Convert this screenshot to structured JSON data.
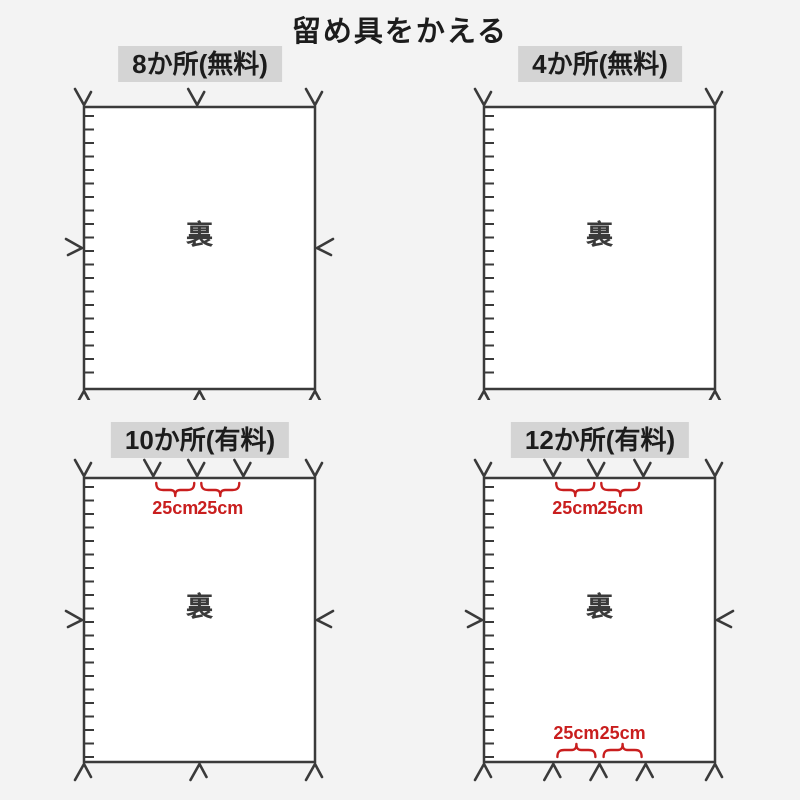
{
  "title": "留め具をかえる",
  "colors": {
    "background": "#f3f3f3",
    "panel_fill": "#ffffff",
    "line": "#3a3a3a",
    "header_bg": "#d4d4d4",
    "accent_red": "#c91e1e"
  },
  "panels": [
    {
      "id": "8-places-free",
      "label": "8か所(無料)",
      "center_label": "裏",
      "top_marks": [
        0,
        0.49,
        1
      ],
      "bottom_marks": [
        0,
        0.5,
        1
      ],
      "side_marks": true,
      "top_braces": [],
      "bottom_braces": []
    },
    {
      "id": "4-places-free",
      "label": "4か所(無料)",
      "center_label": "裏",
      "top_marks": [
        0,
        1
      ],
      "bottom_marks": [
        0,
        1
      ],
      "side_marks": false,
      "top_braces": [],
      "bottom_braces": []
    },
    {
      "id": "10-places-paid",
      "label": "10か所(有料)",
      "center_label": "裏",
      "top_marks": [
        0,
        0.3,
        0.49,
        0.69,
        1
      ],
      "bottom_marks": [
        0,
        0.5,
        1
      ],
      "side_marks": true,
      "top_braces": [
        {
          "between": [
            1,
            2
          ],
          "label": "25cm"
        },
        {
          "between": [
            2,
            3
          ],
          "label": "25cm"
        }
      ],
      "bottom_braces": []
    },
    {
      "id": "12-places-paid",
      "label": "12か所(有料)",
      "center_label": "裏",
      "top_marks": [
        0,
        0.3,
        0.49,
        0.69,
        1
      ],
      "bottom_marks": [
        0,
        0.3,
        0.5,
        0.7,
        1
      ],
      "side_marks": true,
      "top_braces": [
        {
          "between": [
            1,
            2
          ],
          "label": "25cm"
        },
        {
          "between": [
            2,
            3
          ],
          "label": "25cm"
        }
      ],
      "bottom_braces": [
        {
          "between": [
            1,
            2
          ],
          "label": "25cm"
        },
        {
          "between": [
            2,
            3
          ],
          "label": "25cm"
        }
      ]
    }
  ]
}
